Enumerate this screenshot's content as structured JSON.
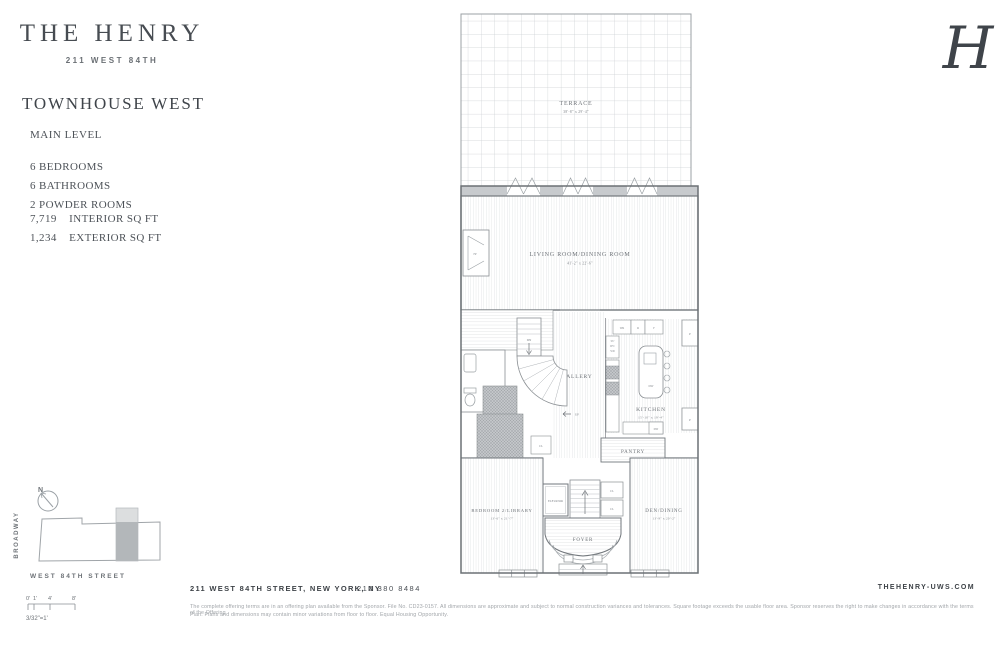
{
  "colors": {
    "text": "#41464c",
    "muted": "#6d7277",
    "line": "#9aa0a5",
    "highlight": "#b3b7ba"
  },
  "brand": {
    "name": "THE HENRY",
    "address": "211 WEST 84TH",
    "monogram": "H"
  },
  "unit": {
    "title": "TOWNHOUSE WEST",
    "level": "MAIN LEVEL",
    "features": [
      "6 BEDROOMS",
      "6 BATHROOMS",
      "2 POWDER ROOMS"
    ],
    "areas": [
      {
        "value": "7,719",
        "label": "INTERIOR SQ FT"
      },
      {
        "value": "1,234",
        "label": "EXTERIOR SQ FT"
      }
    ]
  },
  "plan": {
    "rooms": {
      "terrace": {
        "name": "TERRACE",
        "dims": "38'-8\" x 29'-4\""
      },
      "living": {
        "name": "LIVING ROOM/DINING ROOM",
        "dims": "41'-2\" x 22'-6\""
      },
      "gallery": {
        "name": "GALLERY"
      },
      "kitchen": {
        "name": "KITCHEN",
        "dims": "15'-10\" x 19'-4\""
      },
      "pantry": {
        "name": "PANTRY"
      },
      "bedroom2": {
        "name": "BEDROOM 2/LIBRARY",
        "dims": "13'-6\" x 21'-7\""
      },
      "den": {
        "name": "DEN/DINING",
        "dims": "13'-9\" x 20'-2\""
      },
      "foyer": {
        "name": "FOYER"
      },
      "elevator": {
        "name": "ELEVATOR"
      }
    },
    "labels": {
      "up": "UP",
      "dn": "DN",
      "fp": "FP",
      "cl": "CL",
      "dw": "DW",
      "wr": "WR",
      "r": "R",
      "f": "F",
      "p": "P",
      "st": "ST/",
      "dy": "DY/",
      "wd": "WD"
    }
  },
  "keyplan": {
    "north": "N",
    "avenue": "BROADWAY",
    "street": "WEST 84TH STREET",
    "ticks": [
      "0'",
      "1'",
      "4'",
      "8'"
    ],
    "scale_note": "3/32\"=1'"
  },
  "footer": {
    "address": "211 WEST 84TH STREET, NEW YORK, NY",
    "phone": "212 380 8484",
    "website": "THEHENRY-UWS.COM",
    "disclaimer1": "The complete offering terms are in an offering plan available from the Sponsor. File No. CD23-0157. All dimensions are approximate and subject to normal construction variances and tolerances. Square footage exceeds the usable floor area. Sponsor reserves the right to make changes in accordance with the terms of the Offering",
    "disclaimer2": "Plan. Plans and dimensions may contain minor variations from floor to floor. Equal Housing Opportunity."
  }
}
